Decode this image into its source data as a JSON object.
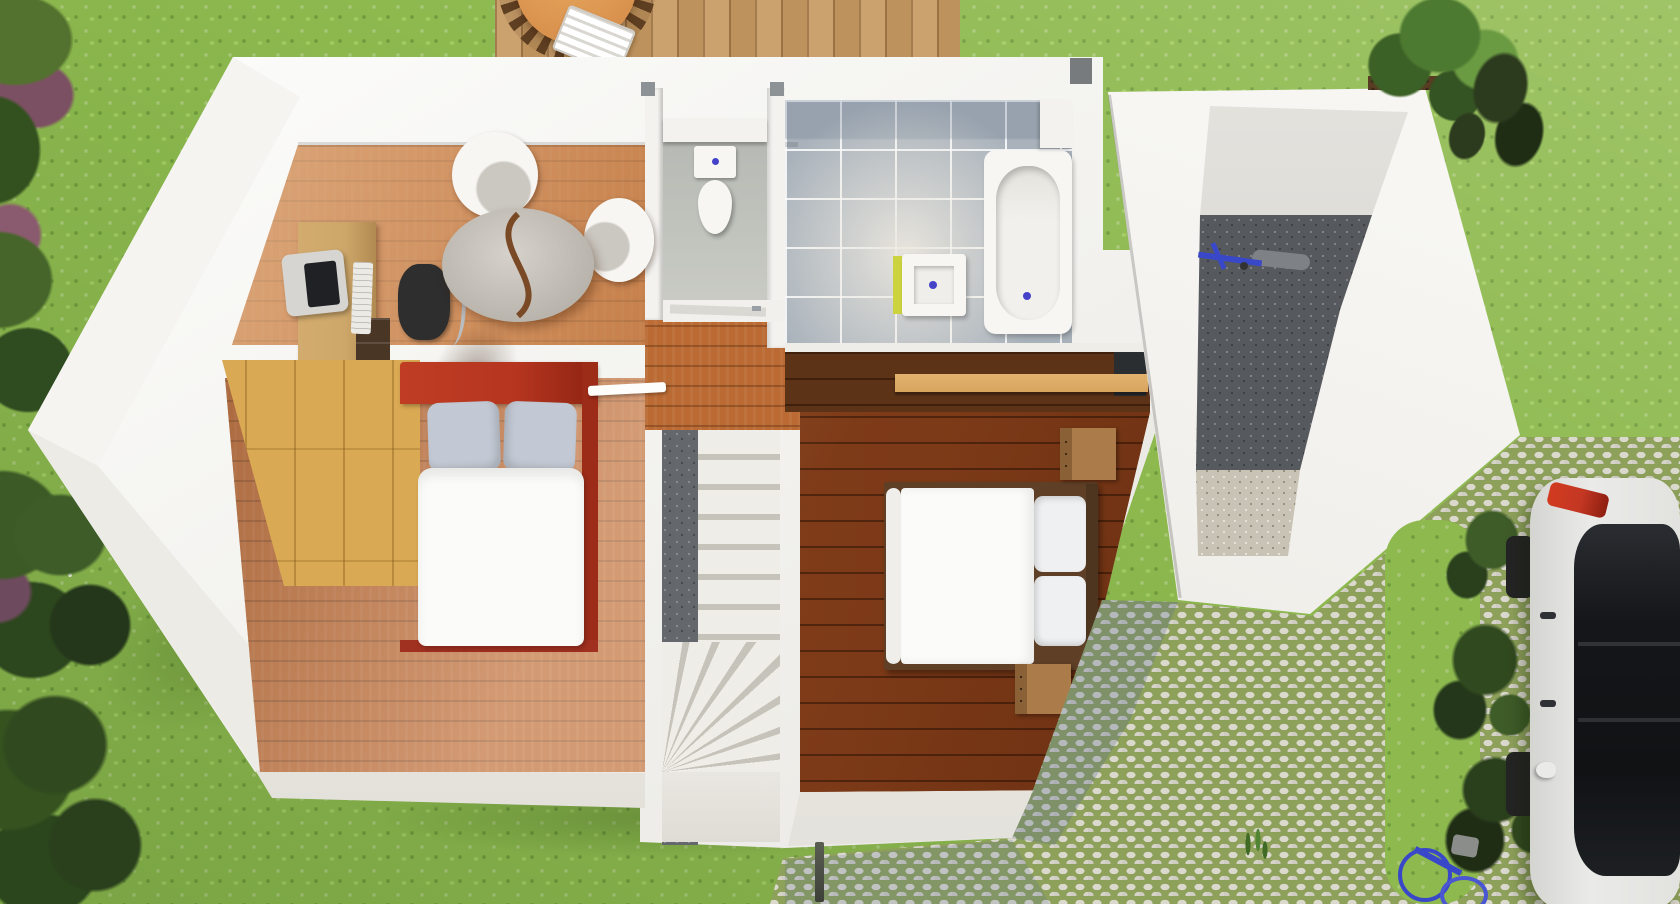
{
  "meta": {
    "description": "Top-down 3D architectural render of an upper floor plan of a house, surrounded by lawn, hedges, a wooden deck, an attached garage annex and a cobblestone driveway with a parked white car",
    "view": "top-down",
    "visible_text": "none"
  },
  "colors": {
    "grass": "#8db94f",
    "wall": "#f3f2ef",
    "wallShade": "#e6e4dd",
    "woodA": "#bb6a33",
    "woodB": "#d58a47",
    "woodDark": "#9c5526",
    "deck": "#c79a62",
    "tableTop": "#d9924e",
    "chairRing": "#5f3f22",
    "wardrobe": "#d9a953",
    "bedRed": "#b5351f",
    "pillowGray": "#c3c9d4",
    "duvet": "#fbfbf9",
    "tile": "#a9b2bb",
    "tileLight": "#e7e3da",
    "fixtureWhite": "#f7f6f3",
    "sinkYellow": "#ccd33f",
    "drainBlue": "#4442c8",
    "treadLight": "#efede7",
    "treadGap": "#c6c3bb",
    "stairCore": "#64676b",
    "corridorWood": "#5c3317",
    "shelfTan": "#d8a55f",
    "nightstand": "#ab7c49",
    "garageDark": "#565a5e",
    "gravel": "#c9c3b5",
    "cobble": "#dbd8ce",
    "cobbleJoint": "#8ea15b",
    "carBody": "#eaeae8",
    "carGlass": "#141619",
    "tailRed": "#c33723",
    "wheelDark": "#242424",
    "bikeBlue": "#3947c9",
    "hedgeDark": "#2f4b20",
    "treeGreen": "#4d7a31",
    "flower": "#7c5063",
    "slotDark": "#2b2e30",
    "deskWood": "#cda76a",
    "chairDark": "#2e2e2e",
    "monitorGray": "#d6d5d1",
    "doorWhite": "#fdfdfb"
  },
  "exterior": {
    "lawn": "grass lawn",
    "left_hedge": "row of trees and flowering shrubs along left edge",
    "bottom_left_shrubs": "dense dark shrubs in bottom-left corner",
    "deck": {
      "label": "wooden terrace deck at top",
      "furniture": [
        "round wooden table",
        "dark slatted chairs around table",
        "white striped lounge chair"
      ]
    },
    "tree_right": "tree with dark shrub beside garage top-right",
    "driveway": {
      "label": "cobblestone driveway with grass joints, bottom right"
    },
    "car": {
      "label": "white car parked on driveway, rear at top",
      "details": [
        "dark glass roof",
        "red tail light",
        "left-side wheels visible",
        "side mirror",
        "door handles"
      ]
    },
    "driveway_bicycle": "blue bicycle at bottom edge of driveway",
    "garden_stake": "small dark post below house bottom wall"
  },
  "house": {
    "walls": "thick white walls, elongated footprint with pointed west tip",
    "rooms": [
      {
        "id": "office",
        "label": "office / study",
        "floor": "orange wood planks",
        "furniture": [
          "wooden desk against left wall",
          "monitor",
          "keyboard",
          "black office chair",
          "dark desk drawers",
          "white armchair",
          "white tub chair",
          "oval glass coffee table with wooden S-divider"
        ]
      },
      {
        "id": "bedroom-1",
        "label": "bedroom 1 (left)",
        "floor": "wood planks",
        "furniture": [
          "pine wardrobe along angled wall",
          "double bed with red frame and headboard",
          "two gray pillows",
          "white duvet",
          "white door leaf"
        ]
      },
      {
        "id": "wc",
        "label": "toilet room (top center)",
        "floor": "gray",
        "furniture": [
          "toilet with cistern and blue button"
        ],
        "details": [
          "white shelf band",
          "door with handle",
          "two gray wall posts"
        ]
      },
      {
        "id": "bathroom",
        "label": "bathroom (top right)",
        "floor": "gray tiles with white grout",
        "furniture": [
          "bathtub with blue drain",
          "square washbasin with blue drain and yellow side panel",
          "white ledge"
        ]
      },
      {
        "id": "closet-corridor",
        "label": "closet corridor below bathroom",
        "floor": "dark wood",
        "furniture": [
          "tan wooden shelf plank",
          "dark storage slot"
        ]
      },
      {
        "id": "staircase",
        "label": "winder staircase (center)",
        "details": [
          "cream straight treads",
          "fanned winder steps",
          "dark speckled core wall",
          "landing at bottom"
        ]
      },
      {
        "id": "bedroom-2",
        "label": "bedroom 2 (right)",
        "floor": "dark wood planks",
        "furniture": [
          "double bed with white duvet",
          "two white pillows",
          "white bolster roll",
          "two wooden nightstands with drawer dots"
        ]
      }
    ]
  },
  "garage": {
    "label": "garage / storage annex on right",
    "floor": [
      "dark concrete upper part",
      "light gravel lower part"
    ],
    "contents": [
      "blue bicycle lying on floor"
    ],
    "details": [
      "brown hedge strip along top wall",
      "pointed east corner"
    ]
  }
}
